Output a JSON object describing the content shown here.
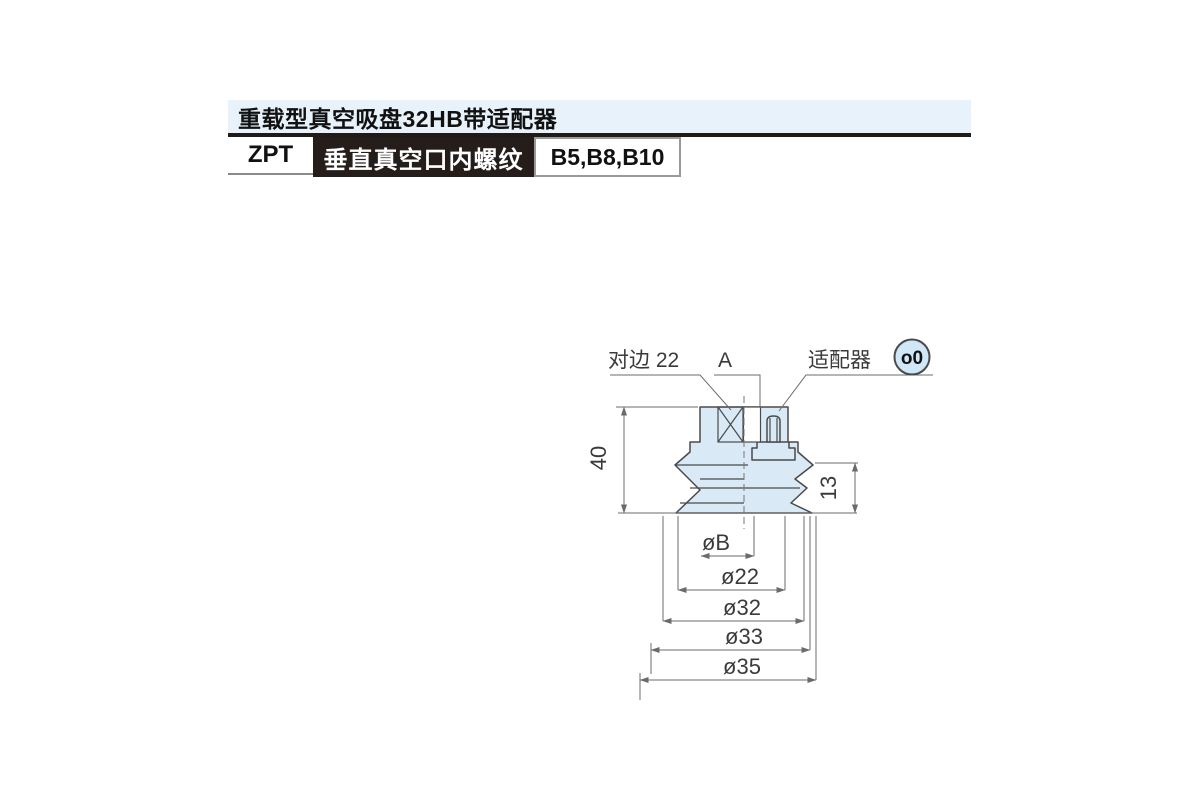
{
  "header": {
    "title": "重载型真空吸盘32HB带适配器",
    "series_code": "ZPT",
    "port_type": "垂直真空口内螺纹",
    "sizes": "B5,B8,B10",
    "title_bg": "#e7f2fb",
    "bar_color": "#211b18"
  },
  "drawing": {
    "labels": {
      "across_flats": "对边 22",
      "port_thread": "A",
      "adapter": "适配器",
      "adapter_badge": "o0",
      "overall_height": "40",
      "bellows_height": "13",
      "dia_b": "øB",
      "dia_22": "ø22",
      "dia_32": "ø32",
      "dia_33": "ø33",
      "dia_35": "ø35"
    },
    "colors": {
      "part_fill": "#d9eaf6",
      "outline": "#4a4a4a",
      "dimension": "#6b6b6b"
    }
  }
}
